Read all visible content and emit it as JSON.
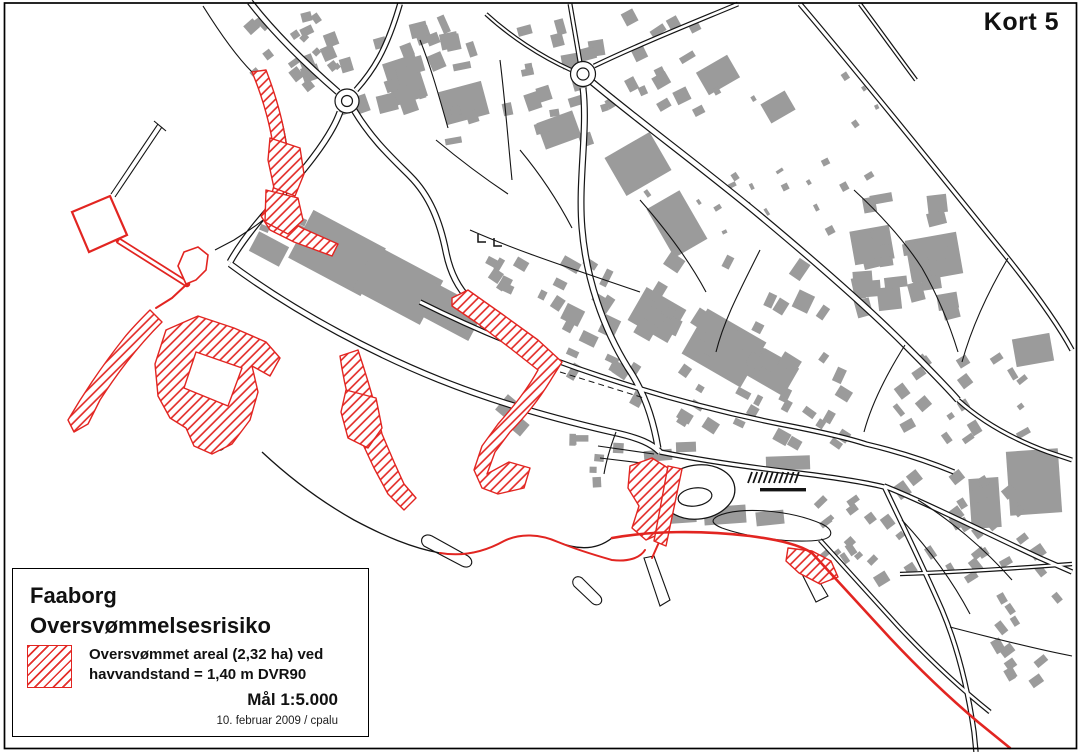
{
  "sheet": {
    "corner_label": "Kort 5"
  },
  "legend": {
    "title_line1": "Faaborg",
    "title_line2": "Oversvømmelsesrisiko",
    "item_line1": "Oversvømmet areal (2,32 ha) ved",
    "item_line2": "havvandstand = 1,40 m DVR90",
    "scale_label": "Mål 1:5.000",
    "date_credit": "10. februar 2009 / cpalu",
    "swatch_meaning": "flooded-area-hatch"
  },
  "colors": {
    "flood_red": "#e22521",
    "building_gray": "#9b9b9b",
    "line_black": "#141414",
    "background": "#ffffff"
  }
}
